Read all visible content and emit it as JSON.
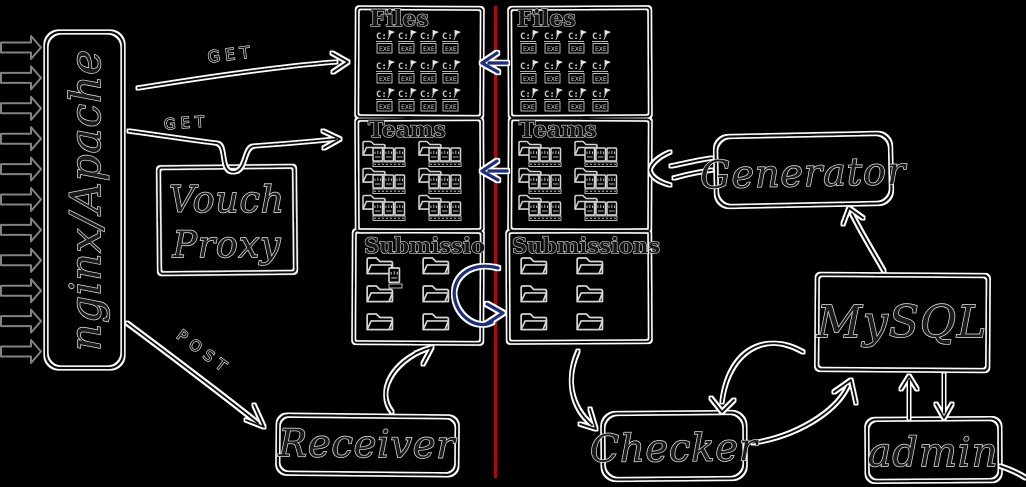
{
  "diagram": {
    "background_color": "#000000",
    "divider_color": "#c80000",
    "sync_arrow_color": "#1f2e7d",
    "nodes": {
      "nginx": {
        "label": "nginx/Apache"
      },
      "vouch_proxy": {
        "line1": "Vouch",
        "line2": "Proxy"
      },
      "generator": {
        "label": "Generator"
      },
      "mysql": {
        "label": "MySQL"
      },
      "admin": {
        "label": "admin"
      },
      "receiver": {
        "label": "Receiver"
      },
      "checker": {
        "label": "Checker"
      }
    },
    "left_column": {
      "files_title": "Files",
      "teams_title": "Teams",
      "submissions_title": "Submissio"
    },
    "right_column": {
      "files_title": "Files",
      "teams_title": "Teams",
      "submissions_title": "Submissions"
    },
    "edge_labels": {
      "get_files": "GET",
      "get_teams": "GET",
      "post": "POST"
    },
    "icon_text": {
      "exe_drive": "C:/",
      "exe_ext": "EXE"
    }
  }
}
